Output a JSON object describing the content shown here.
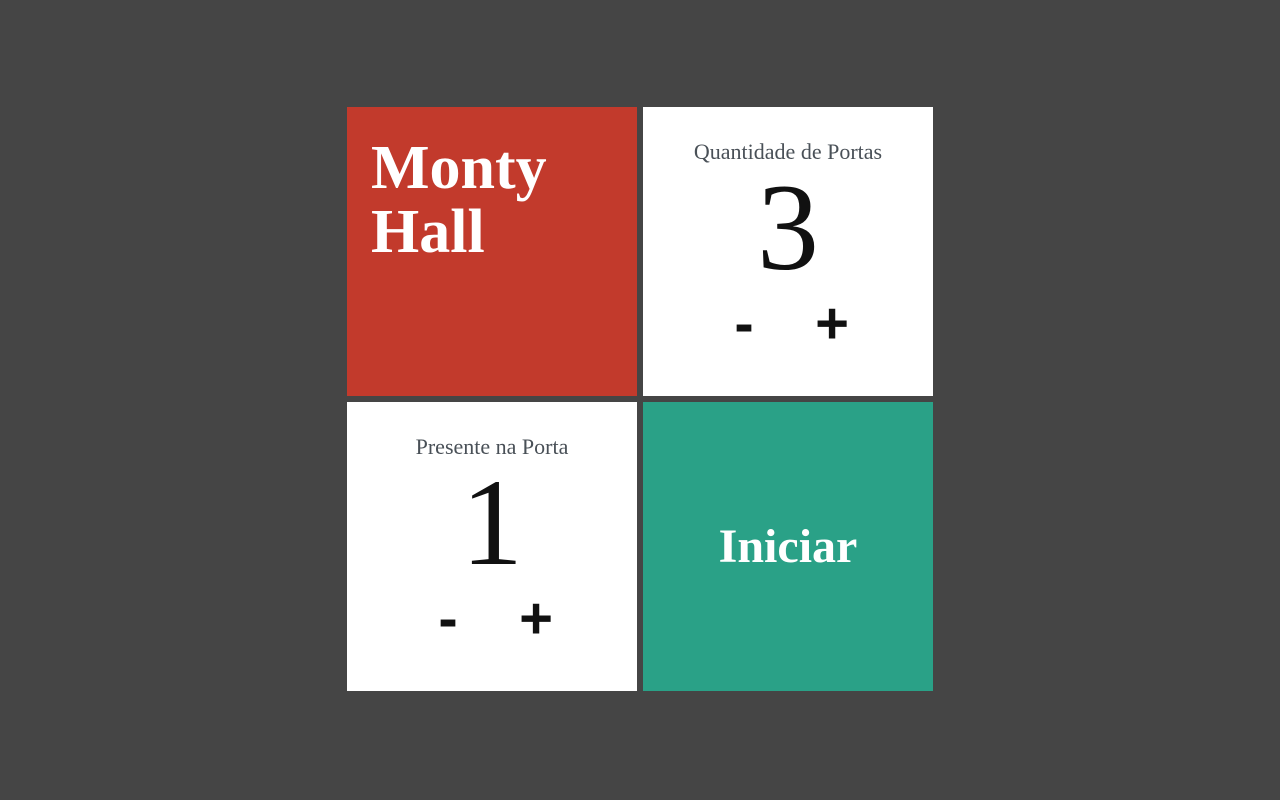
{
  "app": {
    "title": "Monty Hall"
  },
  "panels": {
    "title": {
      "text": "Monty Hall"
    },
    "quantity": {
      "label": "Quantidade de Portas",
      "value": "3",
      "decrement": "-",
      "increment": "+"
    },
    "prize": {
      "label": "Presente na Porta",
      "value": "1",
      "decrement": "-",
      "increment": "+"
    },
    "start": {
      "label": "Iniciar"
    }
  },
  "colors": {
    "background": "#454545",
    "accent_red": "#c23a2c",
    "accent_teal": "#2aa187",
    "panel": "#ffffff",
    "label_gray": "#495057",
    "text_dark": "#111111",
    "text_light": "#ffffff"
  }
}
